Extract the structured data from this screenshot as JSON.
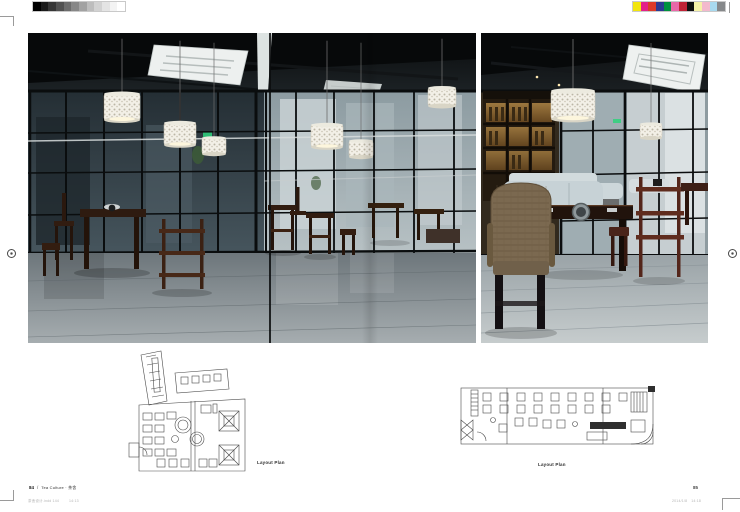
{
  "printer_marks": {
    "grayscale_bar": [
      "#000000",
      "#1b1b1b",
      "#363636",
      "#515151",
      "#6c6c6c",
      "#878787",
      "#a2a2a2",
      "#bdbdbd",
      "#d2d2d2",
      "#e4e4e4",
      "#f3f3f3",
      "#ffffff"
    ],
    "color_bar": [
      "#f2e50e",
      "#e32089",
      "#dc3a2a",
      "#2c3a92",
      "#00913f",
      "#e868a8",
      "#c02336",
      "#111111",
      "#f6f2a8",
      "#f3b9cd",
      "#a8d9ee",
      "#86888a"
    ]
  },
  "photos": {
    "left": {
      "description": "Dark tea-restaurant interior seen through black-framed glass partitions: white lace drum pendant lamps, ceiling cassette air conditioners, dark wood tables, stools and shelf stands on a grey concrete floor"
    },
    "right": {
      "description": "Tea-restaurant dining area: rattan armchair and light upholstered bench at a dark wood hot-pot table, red-brown shelf stand, backlit bottle shelves, glass wall and cassette air conditioners in a black ceiling"
    }
  },
  "plans": {
    "left": {
      "caption": "Layout Plan"
    },
    "right": {
      "caption": "Layout Plan"
    }
  },
  "footer": {
    "left": {
      "page_number": "84",
      "separator": "/",
      "chapter": "Tea Culture · 茶舍",
      "file_info": "茶舍设计.indd 144",
      "time": "14:13"
    },
    "right": {
      "page_number": "85",
      "date": "2014/1/8",
      "time": "14:18"
    }
  }
}
